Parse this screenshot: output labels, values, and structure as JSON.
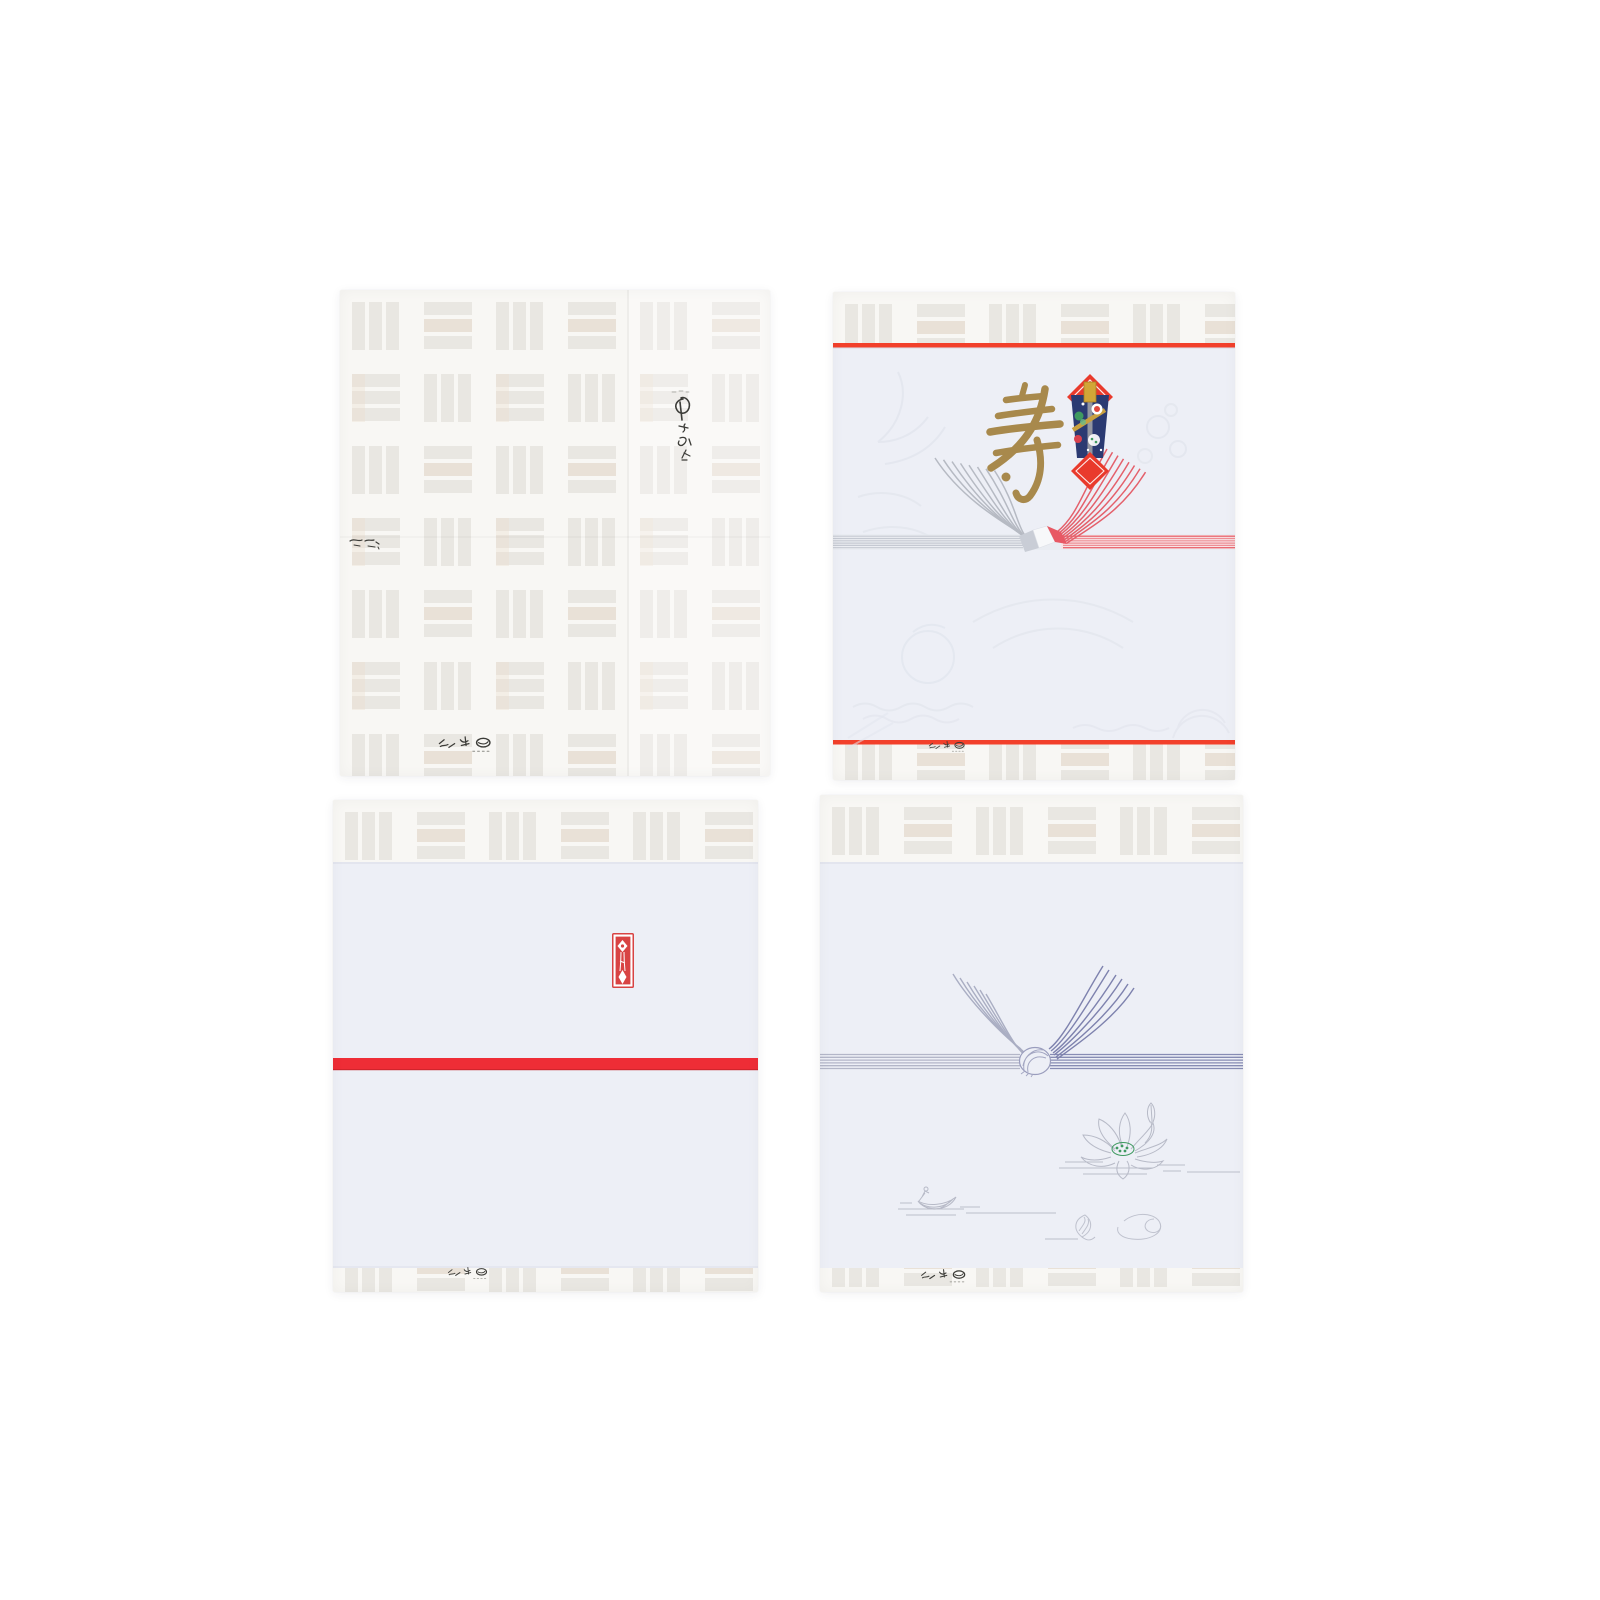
{
  "scene": {
    "description": "Product photo: four gift boxes wrapped in Japanese noshi wrapping papers on a white background",
    "background_color": "#ffffff"
  },
  "packages": [
    {
      "id": "plain-weave-wrap",
      "aria": "Gift box wrapped in pale basket-weave patterned paper with small calligraphy brand marks"
    },
    {
      "id": "celebration-noshi-wrap",
      "kotobuki": "寿",
      "aria": "Gift box with celebratory noshi paper: gold kotobuki calligraphy, ornamental noshi emblem, silver and red mizuhiki ribbon, red border lines, embossed crane and pine motifs"
    },
    {
      "id": "red-band-noshi-wrap",
      "aria": "Gift box with plain white noshi paper, small red noshi seal stamp and a single red band"
    },
    {
      "id": "buddhist-mizuhiki-wrap",
      "aria": "Gift box with funerary noshi paper: blue-purple mizuhiki awaji knot, lotus flower, small boat and cloud line art"
    }
  ],
  "colors": {
    "weave_base": "#f8f7f4",
    "weave_bar": "#e9e7e2",
    "weave_beige": "#eadccb",
    "sheet": "#edeff6",
    "line_red": "#f2402b",
    "band_red": "#ee2d36",
    "stamp_red": "#d84343",
    "gold": "#a8894c",
    "noshi_red": "#e93a2c",
    "noshi_blue": "#2b3a72",
    "noshi_gold": "#d2a637",
    "mizuhiki_silver": "#b6bac3",
    "mizuhiki_red": "#e4606b",
    "mizuhiki_blue_gray": "#aaaec3",
    "mizuhiki_purple": "#7e82ae",
    "lotus_green": "#3f9a60",
    "lineart_gray": "#b7bac7",
    "emboss": "#e2e6ee",
    "ink": "#3c3c38"
  }
}
